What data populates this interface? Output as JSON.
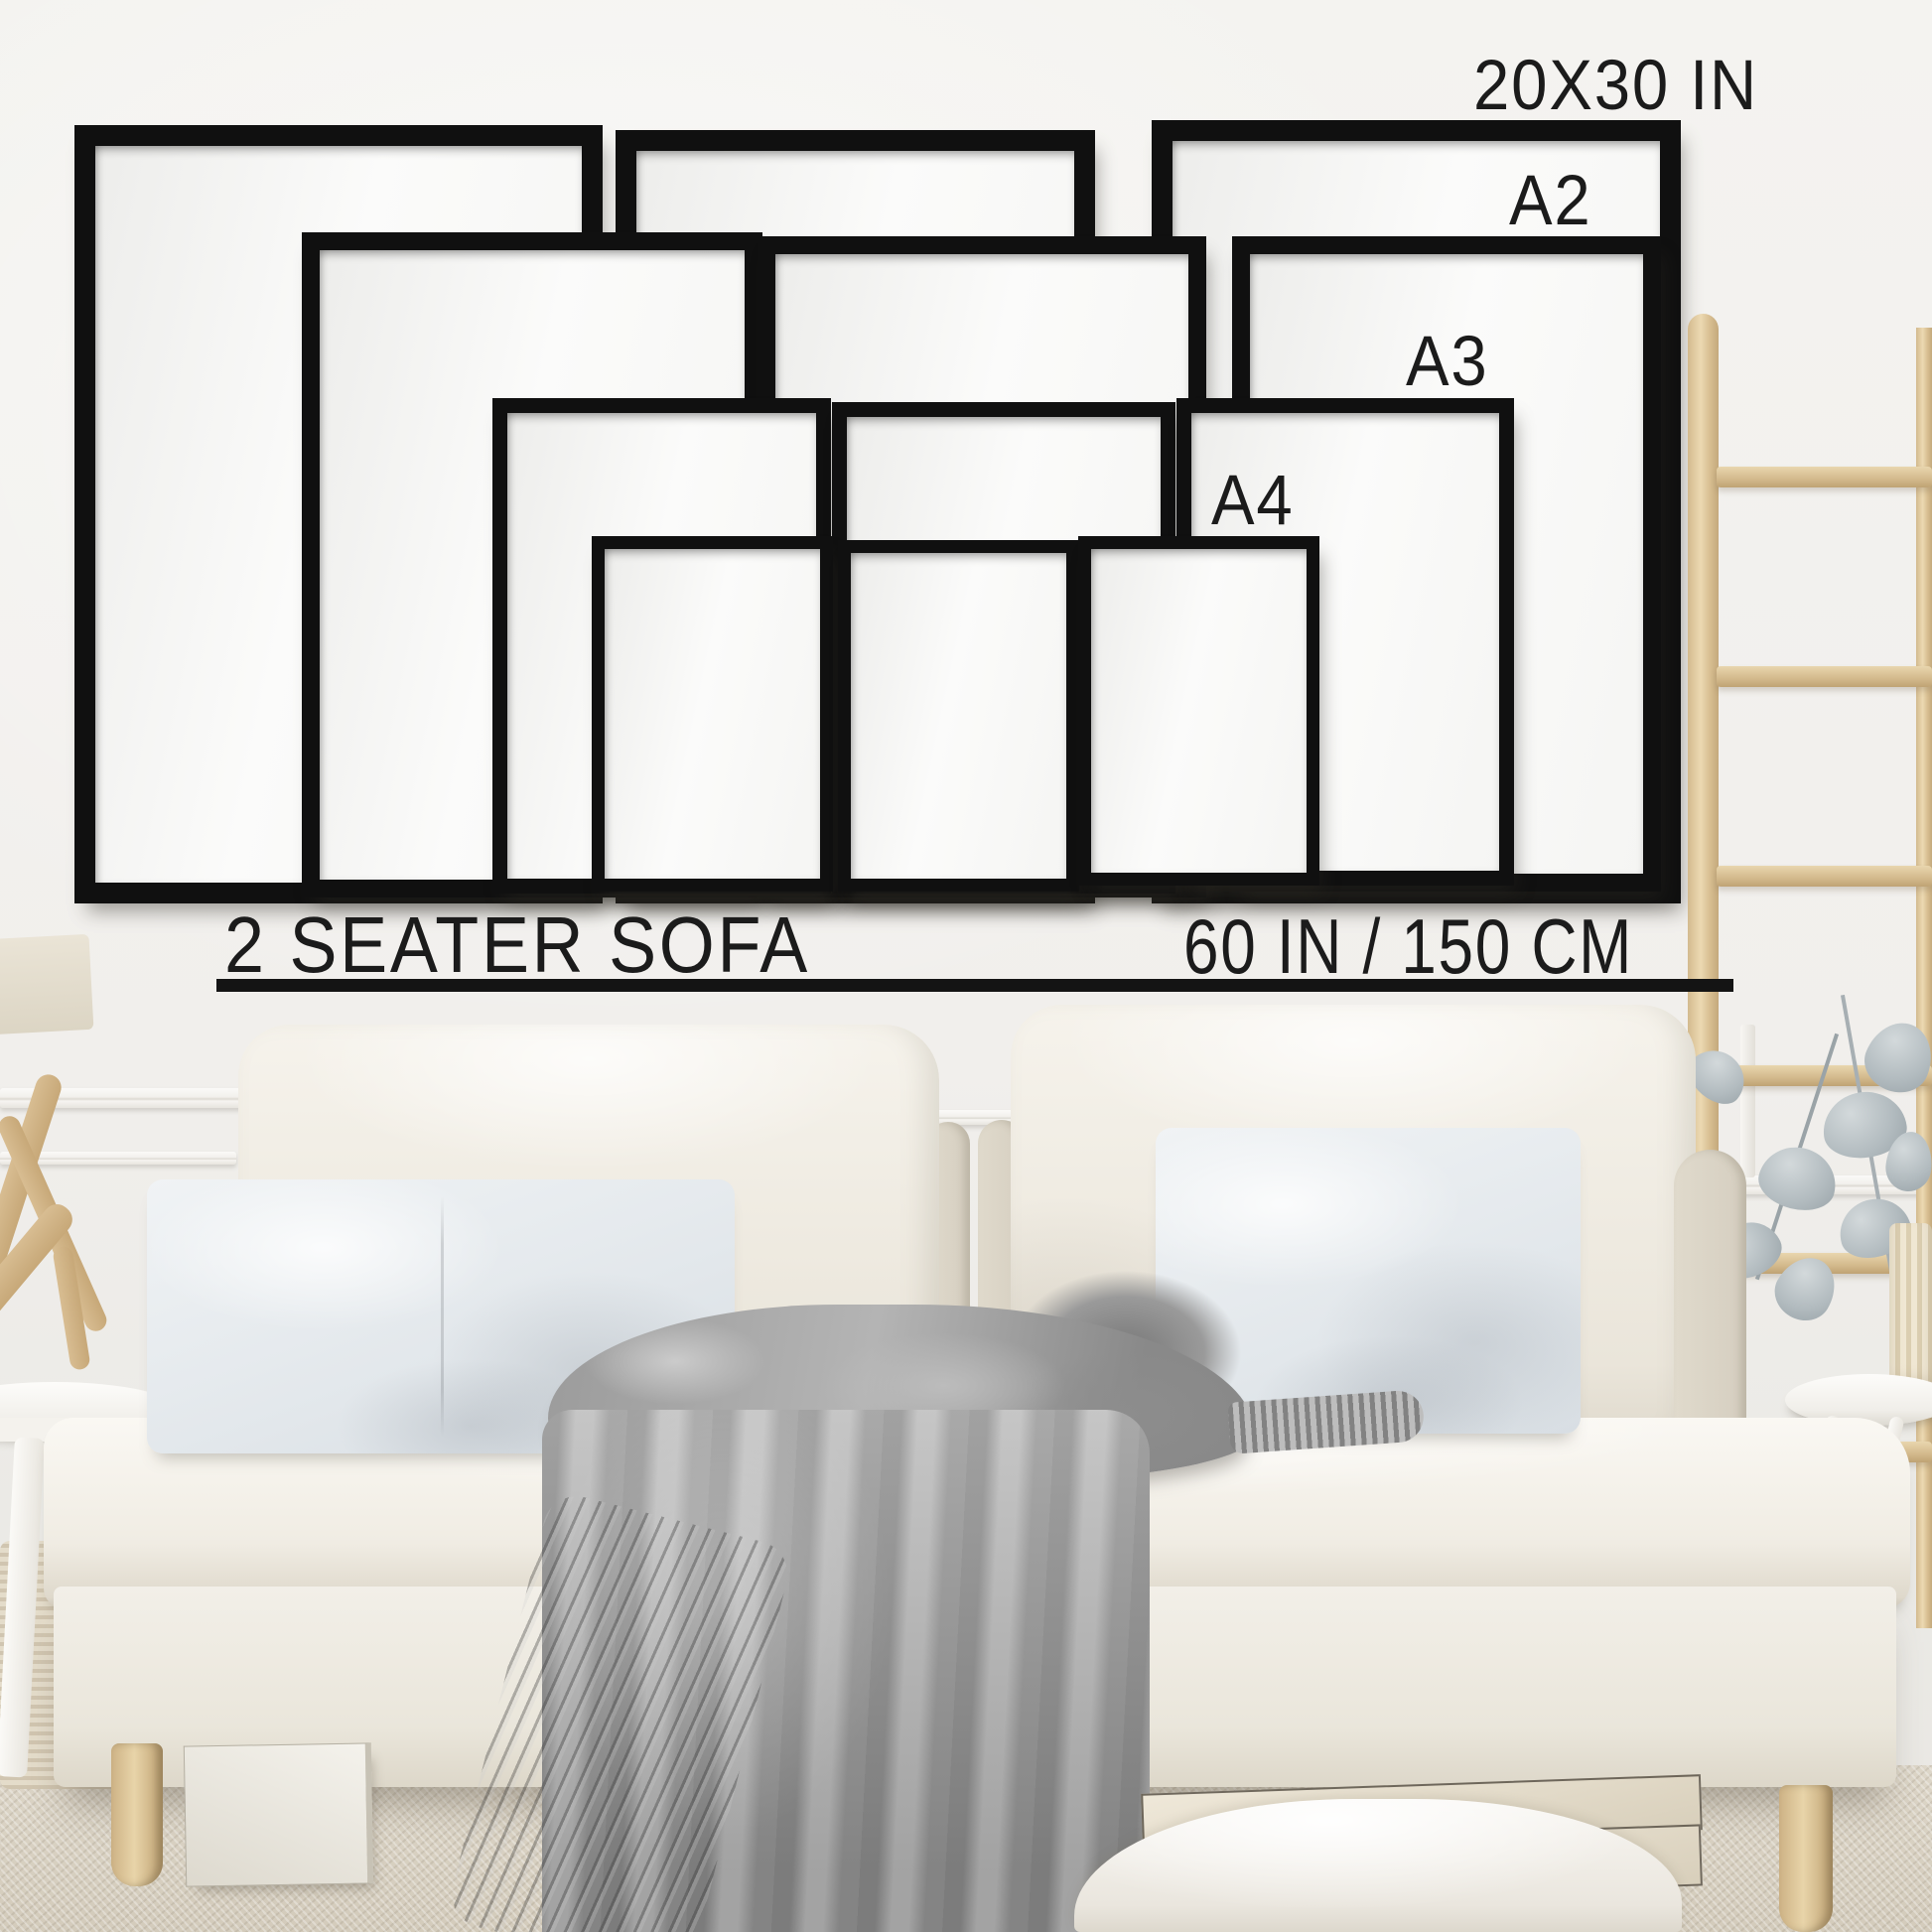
{
  "frame_sizes": [
    {
      "label": "20X30 IN",
      "count": 3
    },
    {
      "label": "A2",
      "count": 3
    },
    {
      "label": "A3",
      "count": 3
    },
    {
      "label": "A4",
      "count": 3
    }
  ],
  "annotations": {
    "sofa_label": "2 SEATER SOFA",
    "sofa_width": "60 IN / 150 CM"
  },
  "colors": {
    "annotation_text": "#1b1b1b",
    "underline": "#141414",
    "frame": "#101010",
    "frame_paper": "#fafaf8",
    "wall": "#f3f2ef",
    "sofa_fabric": "#f2efe8",
    "pillow": "#e9edf0",
    "blanket_gray": "#a3a3a3",
    "wood": "#dcc49c",
    "carpet": "#d7d0c2"
  }
}
